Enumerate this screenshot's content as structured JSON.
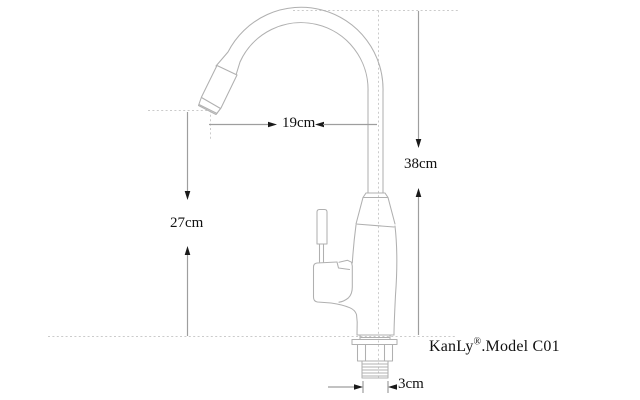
{
  "diagram": {
    "subject": "kitchen-faucet-line-drawing",
    "dimensions": {
      "spout_reach": "19cm",
      "overall_height": "38cm",
      "spout_height": "27cm",
      "inlet_width": "3cm"
    },
    "brand": {
      "name": "KanLy",
      "registered_mark": "®",
      "model": ".Model C01"
    },
    "colors": {
      "background": "#ffffff",
      "drawing_line": "#b0b0b0",
      "dimension_line": "#9e9e9e",
      "guide_dotted": "#cbcbcb",
      "arrow": "#1a1a1a",
      "text": "#111111"
    }
  }
}
